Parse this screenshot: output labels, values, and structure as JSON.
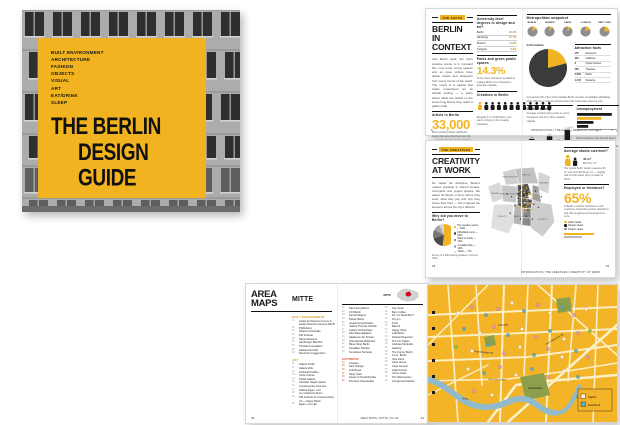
{
  "cover": {
    "categories": [
      "BUILT ENVIRONMENT",
      "ARCHITECTURE",
      "FASHION",
      "OBJECTS",
      "VISUAL",
      "ART",
      "EAT/DRINK",
      "SLEEP"
    ],
    "title_line1": "THE BERLIN",
    "title_line2": "DESIGN GUIDE",
    "accent_color": "#F2B321"
  },
  "facts": {
    "tab": "THE FACTS",
    "title_line1": "BERLIN",
    "title_line2": "IN CONTEXT",
    "intro": "Like Berlin itself, the city's creative scene is in constant flux. Low rents, empty spaces and an open culture have drawn artists and designers from every corner of the world. The result is a capital that treats experiment as its default setting — a place where ideas are tested on the street long before they reach a gallery wall.",
    "artists_label": "Artists in Berlin",
    "artists_value": "33,000",
    "artists_caption": "More working artists call Berlin home than any other German city — and the number keeps growing.",
    "degrees_label": "University-level degrees in design and art?",
    "degrees_rows": [
      {
        "city": "Berlin",
        "value": "22.4%"
      },
      {
        "city": "Hamburg",
        "value": "14.1%"
      },
      {
        "city": "Munich",
        "value": "12.8%"
      },
      {
        "city": "Cologne",
        "value": "9.6%"
      }
    ],
    "parks_label": "Parks and green public spaces",
    "parks_value": "14.3%",
    "parks_caption": "of the city's total area is parkland, making Berlin one of Europe's greenest capitals.",
    "creatives_label": "Creatives in Berlin",
    "creatives_icons": 12,
    "creatives_caption": "Roughly 1 in 10 Berliners now earns a living in the creative industries.",
    "page_left": "6",
    "snapshot_label": "Metropolitan snapshot",
    "attraction_label": "Attraction facts",
    "attraction_rows": [
      {
        "v": "175",
        "l": "Museums"
      },
      {
        "v": "440",
        "l": "Galleries"
      },
      {
        "v": "3",
        "l": "Opera houses"
      },
      {
        "v": "150",
        "l": "Theatres"
      },
      {
        "v": "2,500",
        "l": "Parks"
      },
      {
        "v": "1.2 M",
        "l": "Students"
      }
    ],
    "snapshot_caption": "Compared with other world capitals Berlin remains remarkably affordable, while offering a cultural infrastructure that rivals cities twice its size.",
    "cost_label": "Cost of Living",
    "cost_caption": "Average monthly living costs in euros, compared with four other creative capitals.",
    "unemployment_label": "Unemployment",
    "unemployment_caption": "Berlin's jobless rate still sits above the national average, yet the city's creative economy keeps adding jobs year after year.",
    "footer": "INTRODUCTION  |  THE FACTS  |  BERLIN IN CONTEXT",
    "page_right": "7"
  },
  "work": {
    "tab": "THE CREATIVES",
    "title_line1": "CREATIVITY",
    "title_line2": "AT WORK",
    "intro": "No matter the discipline, Berlin's makers gravitate to shared studios, courtyards and project spaces. We asked hundreds of them where they work, what they pay and why they chose their Kiez — then mapped the answers across the city's districts.",
    "pie_question": "Why did you move to Berlin?",
    "pie_caption": "Survey of 1,200 working creatives, summer 2013.",
    "studio_label": "Average studio size/rent?",
    "studio_stat1": "45 m²",
    "studio_stat2": "€6.50 / m²",
    "studio_caption": "The typical Berlin studio measures 45 m² and costs €6.50 per m² — roughly half of what artists pay in London or Paris.",
    "freelance_label": "Employed or freelance?",
    "freelance_value": "65%",
    "freelance_caption": "of Berlin's creative workforce is self-employed, freelancing across disciplines and often juggling several projects at once.",
    "legend": [
      {
        "label": "Artist studio",
        "color": "#F2B321"
      },
      {
        "label": "Design studio",
        "color": "#1A1A1A"
      },
      {
        "label": "Project space",
        "color": "#8C8C8C"
      }
    ],
    "map_districts": [
      {
        "label": "SPANDAU",
        "x": 14,
        "y": 44,
        "light": true
      },
      {
        "label": "REINICKENDORF",
        "x": 34,
        "y": 22,
        "light": true
      },
      {
        "label": "PANKOW",
        "x": 56,
        "y": 19,
        "light": true
      },
      {
        "label": "MARZAHN",
        "x": 80,
        "y": 30,
        "light": true
      },
      {
        "label": "LICHTENBERG",
        "x": 70,
        "y": 44,
        "light": false
      },
      {
        "label": "CHARLOTTENBURG",
        "x": 32,
        "y": 45,
        "light": true
      },
      {
        "label": "MITTE",
        "x": 51,
        "y": 40,
        "light": false
      },
      {
        "label": "KREUZBERG",
        "x": 53,
        "y": 57,
        "light": false
      },
      {
        "label": "TEMPELHOF",
        "x": 45,
        "y": 75,
        "light": true
      },
      {
        "label": "NEUKÖLLN",
        "x": 57,
        "y": 77,
        "light": false
      },
      {
        "label": "KÖPENICK",
        "x": 78,
        "y": 79,
        "light": true
      },
      {
        "label": "STEGLITZ",
        "x": 23,
        "y": 75,
        "light": true
      }
    ],
    "map_dots_yellow": [
      [
        50,
        38
      ],
      [
        53,
        42
      ],
      [
        49,
        45
      ],
      [
        55,
        47
      ],
      [
        52,
        50
      ],
      [
        57,
        52
      ],
      [
        47,
        52
      ],
      [
        54,
        56
      ],
      [
        58,
        58
      ],
      [
        50,
        59
      ],
      [
        56,
        61
      ],
      [
        60,
        63
      ],
      [
        48,
        62
      ],
      [
        53,
        64
      ],
      [
        61,
        57
      ],
      [
        63,
        50
      ],
      [
        59,
        44
      ],
      [
        46,
        41
      ],
      [
        44,
        48
      ],
      [
        51,
        33
      ],
      [
        56,
        36
      ],
      [
        60,
        40
      ],
      [
        64,
        46
      ],
      [
        62,
        66
      ],
      [
        55,
        68
      ],
      [
        49,
        67
      ]
    ],
    "map_dots_black": [
      [
        48,
        36
      ],
      [
        52,
        39
      ],
      [
        57,
        43
      ],
      [
        45,
        50
      ],
      [
        50,
        54
      ],
      [
        58,
        49
      ],
      [
        54,
        60
      ],
      [
        60,
        54
      ],
      [
        47,
        58
      ],
      [
        52,
        46
      ],
      [
        62,
        44
      ],
      [
        58,
        65
      ],
      [
        44,
        44
      ],
      [
        66,
        58
      ],
      [
        40,
        60
      ],
      [
        36,
        48
      ],
      [
        68,
        40
      ],
      [
        30,
        44
      ],
      [
        72,
        62
      ],
      [
        56,
        74
      ],
      [
        48,
        78
      ],
      [
        64,
        78
      ],
      [
        34,
        70
      ],
      [
        76,
        48
      ]
    ],
    "footer": "INTRODUCTION  |  THE CREATIVES  |  CREATIVITY AT WORK",
    "page_left": "18",
    "page_right": "19"
  },
  "maps": {
    "title_line1": "AREA",
    "title_line2": "MAPS",
    "section": "MITTE",
    "cat_built": "BUILT ENVIRONMENT",
    "built_items": [
      "Aedes Architecture Forum & Aedes Network Campus ANCB",
      "Pfefferberg",
      "Platoon Kunsthalle",
      "KW Institute",
      "Neues Museum",
      "Hamburger Bahnhof",
      "Tchoban Foundation",
      "Hackesche Höfe",
      "Deutsche Guggenheim"
    ],
    "cat_art": "ART",
    "art_items": [
      "Galerie KOW",
      "Galerie Zink",
      "Schinkel Pavillon",
      "Circle Culture",
      "DAAD Galerie",
      "Christian Nagel Galerie",
      "Contemporary Fine Arts",
      "Galerie Eigen + Art",
      "me Collectors Room",
      "KW Institute for Contemporary Art — Dauer Berlin",
      "Eigen + Art Lab"
    ],
    "col1_items": [
      "Sammlung Boros",
      "C/O Berlin",
      "Sprüth Magers",
      "Kicken Berlin",
      "neugerriemschneider",
      "Galerie Thomas Schulte",
      "Galerie Nordenhake",
      "Alte Nationalgalerie",
      "Akademie der Künste",
      "International Wardrobe",
      "Bless Shop Berlin",
      "Gestalten Pavilion",
      "Kunsthaus Tacheles"
    ],
    "cat_eat": "EAT/DRINK",
    "eat_items": [
      "Cookies",
      "Katz Orange",
      "Grill Royal",
      "Pauly Saal",
      "House of Small Wonder",
      "Princess Cheesecake"
    ],
    "col2_items": [
      "City Kiosk",
      "Barn Coffee",
      "Do You Read Me?!",
      "Pro qm",
      "Konk",
      "Baerck",
      "Happy Shop",
      "Lala Berlin",
      "Schwarzhogerzeil",
      "R.S.V.P. Papier",
      "Andreas Murkudis",
      "Hecking",
      "The Corner Berlin",
      "14 oz. Berlin",
      "Soto Store",
      "Soho House",
      "Casa Camper",
      "Hotel Amano",
      "Circus Hotel",
      "The Weinmeister",
      "Honigmond Garden"
    ],
    "minimap_label": "MITTE",
    "footer": "AREA MAPS  |  MITTE  |  01–63",
    "page_left": "30",
    "page_right": "31"
  },
  "mappage": {
    "street_labels": [
      {
        "t": "Torstraße",
        "x": 70,
        "y": 41,
        "r": -3
      },
      {
        "t": "Oranienburger Str.",
        "x": 46,
        "y": 67,
        "r": 6
      },
      {
        "t": "Unter den Linden",
        "x": 60,
        "y": 95,
        "r": 1
      },
      {
        "t": "Karl-Liebknecht-Str.",
        "x": 118,
        "y": 60,
        "r": -30
      },
      {
        "t": "Spree",
        "x": 34,
        "y": 114,
        "r": 8
      },
      {
        "t": "Monbijoupark",
        "x": 100,
        "y": 104,
        "r": 0
      }
    ],
    "legend": [
      {
        "label": "Sights",
        "color": "#FDF4DE"
      },
      {
        "label": "Eat/Drink",
        "color": "#5FB0BE"
      }
    ],
    "dots": [
      [
        30,
        28,
        "w"
      ],
      [
        44,
        22,
        "p"
      ],
      [
        58,
        30,
        "t"
      ],
      [
        70,
        24,
        "p"
      ],
      [
        84,
        18,
        "w"
      ],
      [
        96,
        26,
        "t"
      ],
      [
        110,
        20,
        "p"
      ],
      [
        122,
        28,
        "w"
      ],
      [
        134,
        22,
        "t"
      ],
      [
        146,
        30,
        "p"
      ],
      [
        158,
        24,
        "w"
      ],
      [
        36,
        44,
        "t"
      ],
      [
        52,
        48,
        "w"
      ],
      [
        66,
        42,
        "p"
      ],
      [
        80,
        50,
        "t"
      ],
      [
        94,
        44,
        "w"
      ],
      [
        108,
        52,
        "p"
      ],
      [
        122,
        46,
        "t"
      ],
      [
        136,
        54,
        "w"
      ],
      [
        150,
        48,
        "p"
      ],
      [
        28,
        62,
        "g"
      ],
      [
        44,
        66,
        "w"
      ],
      [
        60,
        60,
        "t"
      ],
      [
        76,
        68,
        "p"
      ],
      [
        92,
        62,
        "w"
      ],
      [
        106,
        70,
        "t"
      ],
      [
        120,
        64,
        "p"
      ],
      [
        134,
        72,
        "w"
      ],
      [
        148,
        66,
        "t"
      ],
      [
        160,
        72,
        "p"
      ],
      [
        40,
        84,
        "w"
      ],
      [
        56,
        88,
        "t"
      ],
      [
        72,
        82,
        "p"
      ],
      [
        88,
        90,
        "w"
      ],
      [
        104,
        84,
        "t"
      ],
      [
        120,
        92,
        "p"
      ],
      [
        136,
        86,
        "w"
      ],
      [
        150,
        92,
        "t"
      ],
      [
        46,
        106,
        "p"
      ],
      [
        64,
        110,
        "w"
      ],
      [
        150,
        112,
        "t"
      ],
      [
        162,
        46,
        "g"
      ]
    ]
  },
  "chart_data": [
    {
      "id": "city-pies",
      "type": "pie",
      "note": "creative-sector share by city",
      "series": [
        {
          "name": "BERLIN",
          "value": 14
        },
        {
          "name": "MADRID",
          "value": 9
        },
        {
          "name": "PARIS",
          "value": 11
        },
        {
          "name": "LONDON",
          "value": 17
        },
        {
          "name": "NEW YORK",
          "value": 23
        }
      ],
      "colors": [
        "#F2B321",
        "#8E8E8E"
      ]
    },
    {
      "id": "big-pie",
      "type": "pie",
      "title": "3.4 M residents",
      "labels": [
        "Creative sector",
        "Other"
      ],
      "values": [
        21,
        79
      ],
      "colors": [
        "#F2B321",
        "#3B3B3B"
      ]
    },
    {
      "id": "cost-bars",
      "type": "bar",
      "title": "Cost of Living",
      "categories": [
        "Madrid",
        "Berlin",
        "Paris",
        "Munich",
        "New York"
      ],
      "values": [
        760,
        500,
        900,
        620,
        1240
      ],
      "highlight": 1,
      "ylim": [
        0,
        1400
      ],
      "ylabel": "€ / month"
    },
    {
      "id": "unemp-bars",
      "type": "hbar",
      "title": "Unemployment",
      "categories": [
        "Madrid",
        "Berlin",
        "Paris",
        "London"
      ],
      "values": [
        17.4,
        12.1,
        8.2,
        5.6
      ],
      "highlight": 1,
      "xlim": [
        0,
        20
      ],
      "xticks": [
        0,
        10,
        20
      ]
    },
    {
      "id": "move-pie",
      "type": "pie",
      "title": "Why did you move to Berlin?",
      "labels": [
        "The creative scene",
        "Affordable rents",
        "Work or study",
        "A relationship",
        "Other"
      ],
      "values": [
        52,
        18,
        13,
        10,
        7
      ],
      "colors": [
        "#F2B321",
        "#4A4A4A",
        "#767676",
        "#A5A5A5",
        "#D6D6D6"
      ]
    }
  ]
}
